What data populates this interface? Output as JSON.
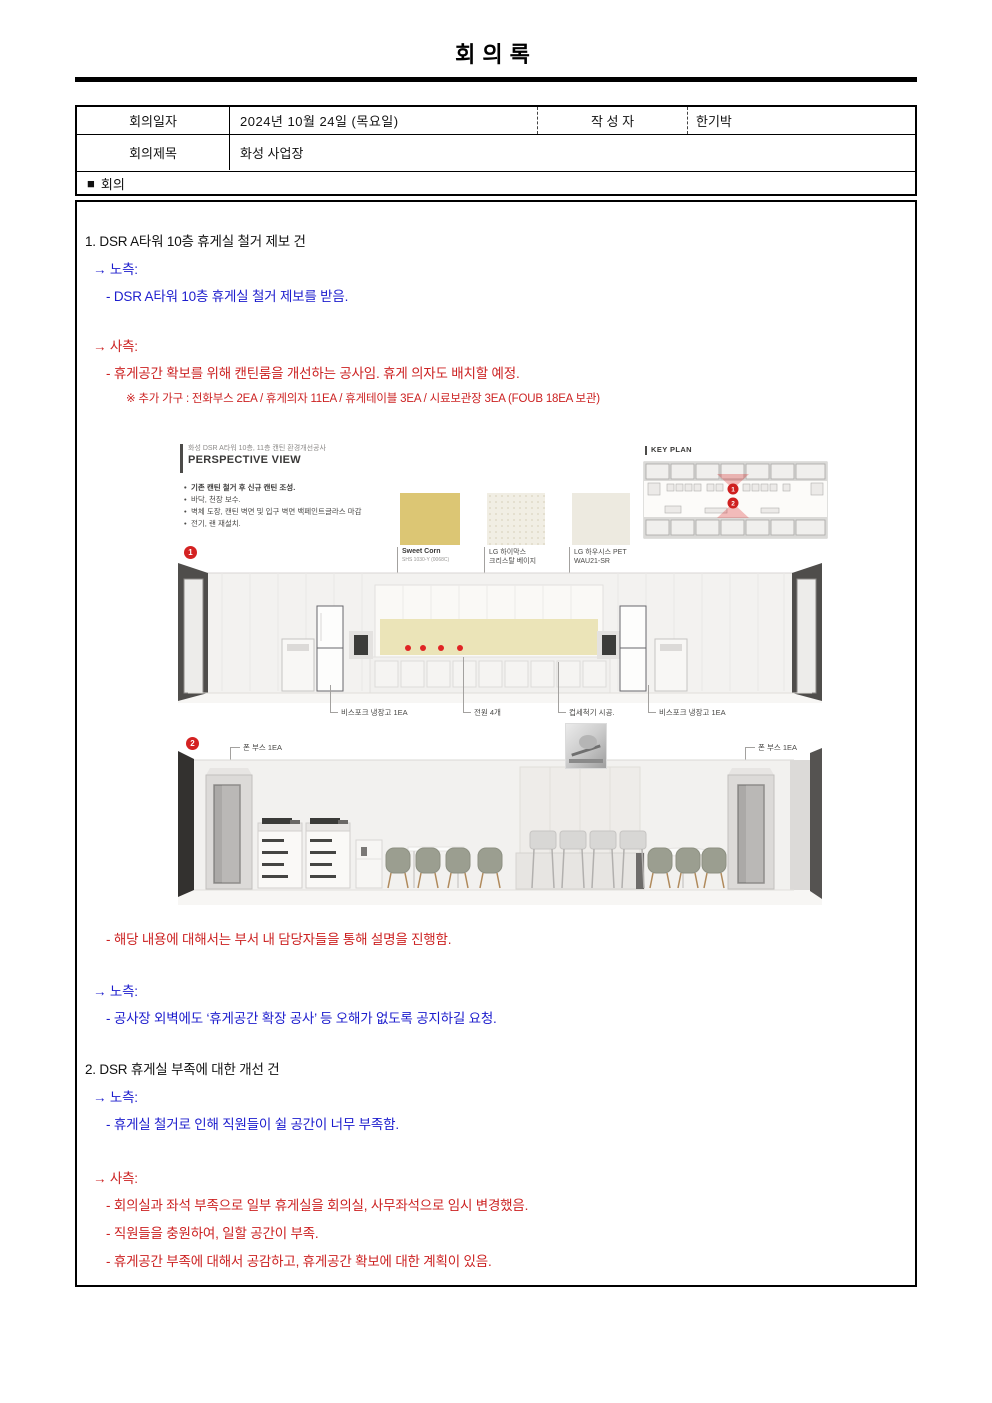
{
  "document": {
    "title": "회의록"
  },
  "info_table": {
    "date_label": "회의일자",
    "date_value": "2024년 10월 24일 (목요일)",
    "author_label": "작 성 자",
    "author_value": "한기박",
    "subject_label": "회의제목",
    "subject_value": "화성 사업장",
    "section_marker": "■",
    "section_title": "회의"
  },
  "minutes": {
    "lines": [
      {
        "text": "1. DSR A타워 10층 휴게실 철거 제보 건",
        "tone": "black"
      },
      {
        "text": "→ 노측:",
        "tone": "blue"
      },
      {
        "text": "- DSR A타워 10층 휴게실 철거 제보를 받음.",
        "tone": "blue"
      },
      {
        "text": "→ 사측:",
        "tone": "red"
      },
      {
        "text": "- 휴게공간 확보를 위해 캔틴룸을 개선하는 공사임. 휴게 의자도 배치할 예정.",
        "tone": "red"
      },
      {
        "text": "※ 추가 가구 : 전화부스 2EA / 휴게의자 11EA / 휴게테이블 3EA / 시료보관장 3EA (FOUB 18EA 보관)",
        "tone": "red",
        "size": "small"
      },
      {
        "text": "- 해당 내용에 대해서는 부서 내 담당자들을 통해 설명을 진행함.",
        "tone": "red"
      },
      {
        "text": "→ 노측:",
        "tone": "blue"
      },
      {
        "text": "- 공사장 외벽에도 ‘휴게공간 확장 공사’ 등 오해가 없도록 공지하길 요청.",
        "tone": "blue"
      },
      {
        "text": "2. DSR 휴게실 부족에 대한 개선 건",
        "tone": "black"
      },
      {
        "text": "→ 노측:",
        "tone": "blue"
      },
      {
        "text": "- 휴게실 철거로 인해 직원들이 쉴 공간이 너무 부족함.",
        "tone": "blue"
      },
      {
        "text": "→ 사측:",
        "tone": "red"
      },
      {
        "text": "- 회의실과 좌석 부족으로 일부 휴게실을 회의실, 사무좌석으로 임시 변경했음.",
        "tone": "red"
      },
      {
        "text": "- 직원들을 충원하여, 일할 공간이 부족.",
        "tone": "red"
      },
      {
        "text": "- 휴게공간 부족에 대해서 공감하고, 휴게공간 확보에 대한 계획이 있음.",
        "tone": "red"
      }
    ]
  },
  "figure": {
    "project_caption": "화성 DSR A타워 10층, 11층 캔틴 환경개선공사",
    "view_title": "PERSPECTIVE VIEW",
    "bullets": [
      "기존 캔틴 철거 후 신규 캔틴 조성.",
      "바닥, 천장 보수.",
      "벽체 도장, 캔틴 벽면 및 입구 벽면 백페인트글라스 마감",
      "전기, 랜 재설치."
    ],
    "keyplan_title": "KEY PLAN",
    "marker1": "1",
    "marker2": "2",
    "swatches": [
      {
        "line1": "Sweet Corn",
        "line2": "SHS 1030-Y (0068C)",
        "color": "#dcc674"
      },
      {
        "line1": "LG 하이막스",
        "line2": "크리스탈 베이지",
        "color": "#f1eee4"
      },
      {
        "line1": "LG 하우시스 PET",
        "line2": "WAU21-SR",
        "color": "#edeae0"
      }
    ],
    "view1_callouts": [
      "비스포크 냉장고 1EA",
      "전원 4개",
      "컵세척기 시공.",
      "비스포크 냉장고 1EA"
    ],
    "view2_callouts": [
      "폰 부스 1EA",
      "폰 부스 1EA"
    ]
  },
  "colors": {
    "text_black": "#111111",
    "text_blue": "#1c1ccd",
    "text_red": "#cc2222",
    "marker_red": "#d42222",
    "swatch_yellow": "#dcc674",
    "backsplash_yellow": "#ebe4b8"
  }
}
